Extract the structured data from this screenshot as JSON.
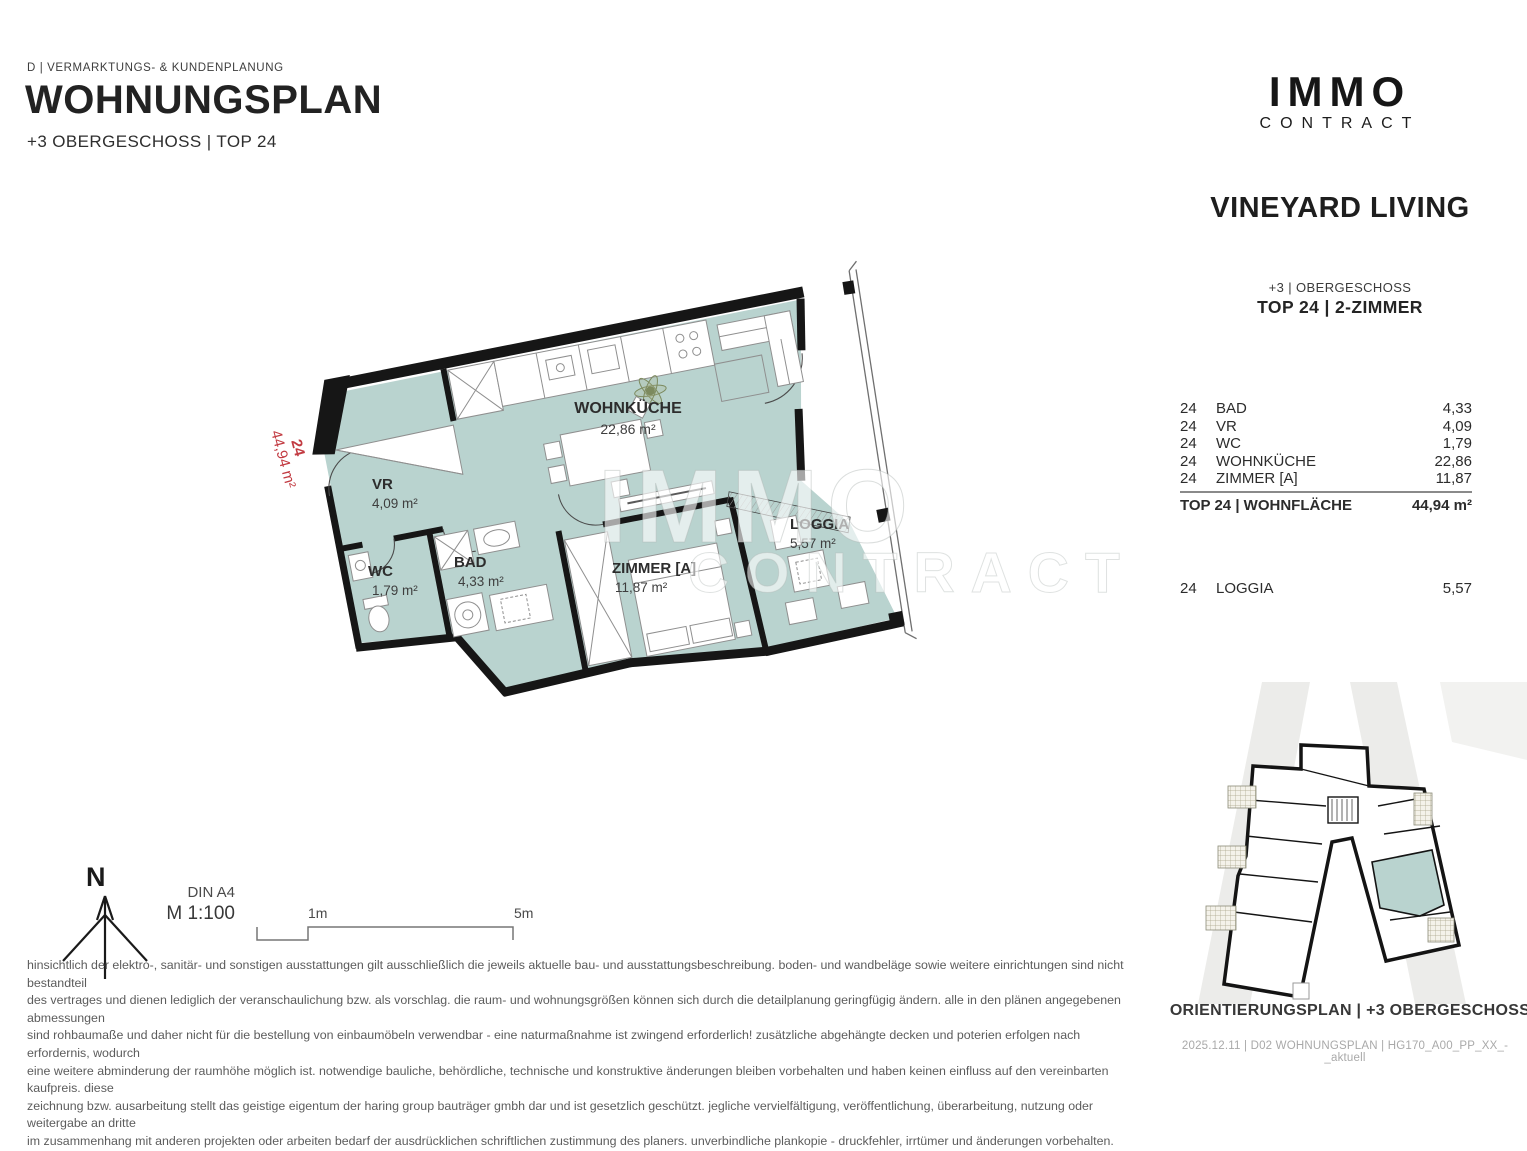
{
  "header": {
    "department": "D | VERMARKTUNGS- & KUNDENPLANUNG",
    "title": "WOHNUNGSPLAN",
    "subtitle": "+3 OBERGESCHOSS | TOP 24"
  },
  "brand": {
    "logo_line1": "IMMO",
    "logo_line2": "CONTRACT",
    "project": "VINEYARD LIVING"
  },
  "unit_panel": {
    "floor": "+3 | OBERGESCHOSS",
    "unit": "TOP 24 | 2-ZIMMER",
    "rows": [
      {
        "no": "24",
        "name": "BAD",
        "area": "4,33"
      },
      {
        "no": "24",
        "name": "VR",
        "area": "4,09"
      },
      {
        "no": "24",
        "name": "WC",
        "area": "1,79"
      },
      {
        "no": "24",
        "name": "WOHNKÜCHE",
        "area": "22,86"
      },
      {
        "no": "24",
        "name": "ZIMMER [A]",
        "area": "11,87"
      }
    ],
    "total_label": "TOP 24 | WOHNFLÄCHE",
    "total_value": "44,94 m²",
    "loggia_row": {
      "no": "24",
      "name": "LOGGIA",
      "area": "5,57"
    }
  },
  "plan": {
    "unit_number": "24",
    "unit_area": "44,94 m²",
    "rooms": [
      {
        "name": "WOHNKÜCHE",
        "area": "22,86 m²"
      },
      {
        "name": "VR",
        "area": "4,09 m²"
      },
      {
        "name": "WC",
        "area": "1,79 m²"
      },
      {
        "name": "BAD",
        "area": "4,33 m²"
      },
      {
        "name": "ZIMMER [A]",
        "area": "11,87 m²"
      },
      {
        "name": "LOGGIA",
        "area": "5,57 m²"
      }
    ],
    "watermark_line1": "IMMO",
    "watermark_line2": "CONTRACT"
  },
  "legend": {
    "north_letter": "N",
    "paper_format": "DIN A4",
    "scale": "M 1:100",
    "scale_mark_1": "1m",
    "scale_mark_2": "5m"
  },
  "disclaimer_lines": [
    "hinsichtlich der elektro-, sanitär- und sonstigen ausstattungen gilt ausschließlich die jeweils aktuelle bau- und ausstattungsbeschreibung. boden- und wandbeläge sowie weitere einrichtungen sind nicht bestandteil",
    "des vertrages und dienen lediglich der veranschaulichung bzw. als vorschlag. die raum- und wohnungsgrößen können sich durch die detailplanung geringfügig ändern. alle in den plänen angegebenen abmessungen",
    "sind rohbaumaße und daher nicht für die bestellung von einbaumöbeln verwendbar - eine naturmaßnahme ist zwingend erforderlich! zusätzliche abgehängte decken und poterien erfolgen nach erfordernis, wodurch",
    "eine weitere abminderung der raumhöhe möglich ist. notwendige bauliche, behördliche, technische und konstruktive änderungen bleiben vorbehalten und haben keinen einfluss auf den vereinbarten kaufpreis. diese",
    "zeichnung bzw. ausarbeitung stellt das geistige eigentum der haring group bauträger gmbh dar und ist gesetzlich geschützt. jegliche vervielfältigung, veröffentlichung, überarbeitung, nutzung oder weitergabe an dritte",
    "im zusammenhang mit anderen projekten oder arbeiten bedarf der ausdrücklichen schriftlichen zustimmung des planers. unverbindliche plankopie - druckfehler, irrtümer und änderungen vorbehalten."
  ],
  "minimap": {
    "caption": "ORIENTIERUNGSPLAN | +3 OBERGESCHOSS",
    "file_info": "2025.12.11 | D02 WOHNUNGSPLAN | HG170_A00_PP_XX_-_aktuell"
  },
  "colors": {
    "room_fill": "#b9d3cf",
    "wall": "#161616",
    "red_label": "#c23b42",
    "street_gray": "#ececea"
  }
}
